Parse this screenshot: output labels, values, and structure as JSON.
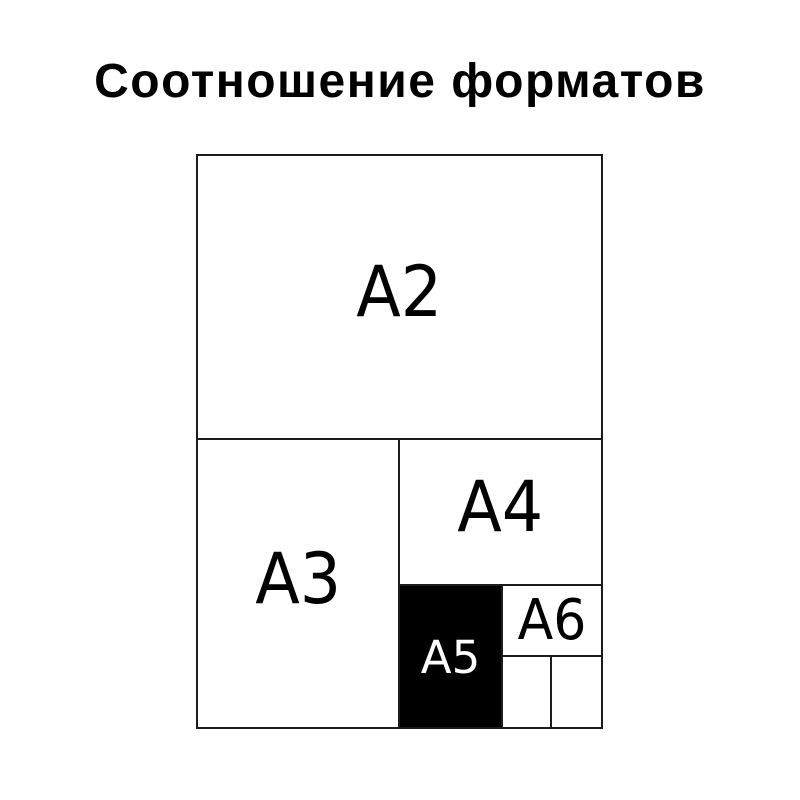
{
  "title": "Соотношение форматов",
  "colors": {
    "background": "#ffffff",
    "line": "#1c1c1c",
    "label": "#000000",
    "a5_fill": "#000000",
    "a5_label": "#ffffff"
  },
  "diagram": {
    "description": "nested paper size ratio diagram",
    "formats": [
      {
        "id": "a2",
        "label": "A2"
      },
      {
        "id": "a3",
        "label": "A3"
      },
      {
        "id": "a4",
        "label": "A4"
      },
      {
        "id": "a5",
        "label": "A5"
      },
      {
        "id": "a6",
        "label": "A6"
      }
    ]
  }
}
